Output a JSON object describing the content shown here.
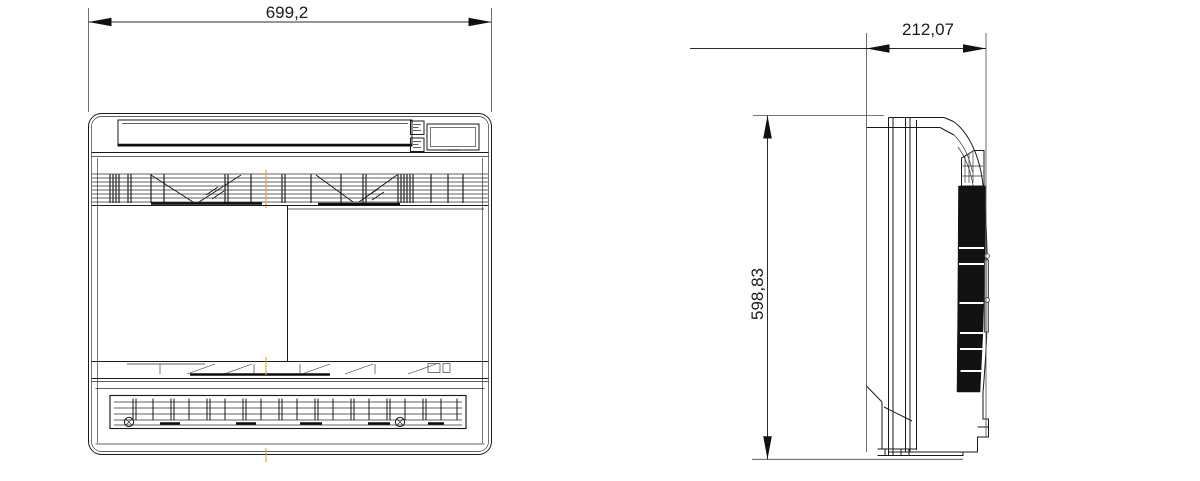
{
  "drawing": {
    "colors": {
      "background": "#ffffff",
      "line": "#1a1a1a",
      "dimension_line": "#2b2b2b",
      "centerline": "#e2a23a"
    },
    "dimensions": {
      "front_width": {
        "label": "699,2"
      },
      "side_depth": {
        "label": "212,07"
      },
      "side_height": {
        "label": "598,83"
      }
    }
  }
}
